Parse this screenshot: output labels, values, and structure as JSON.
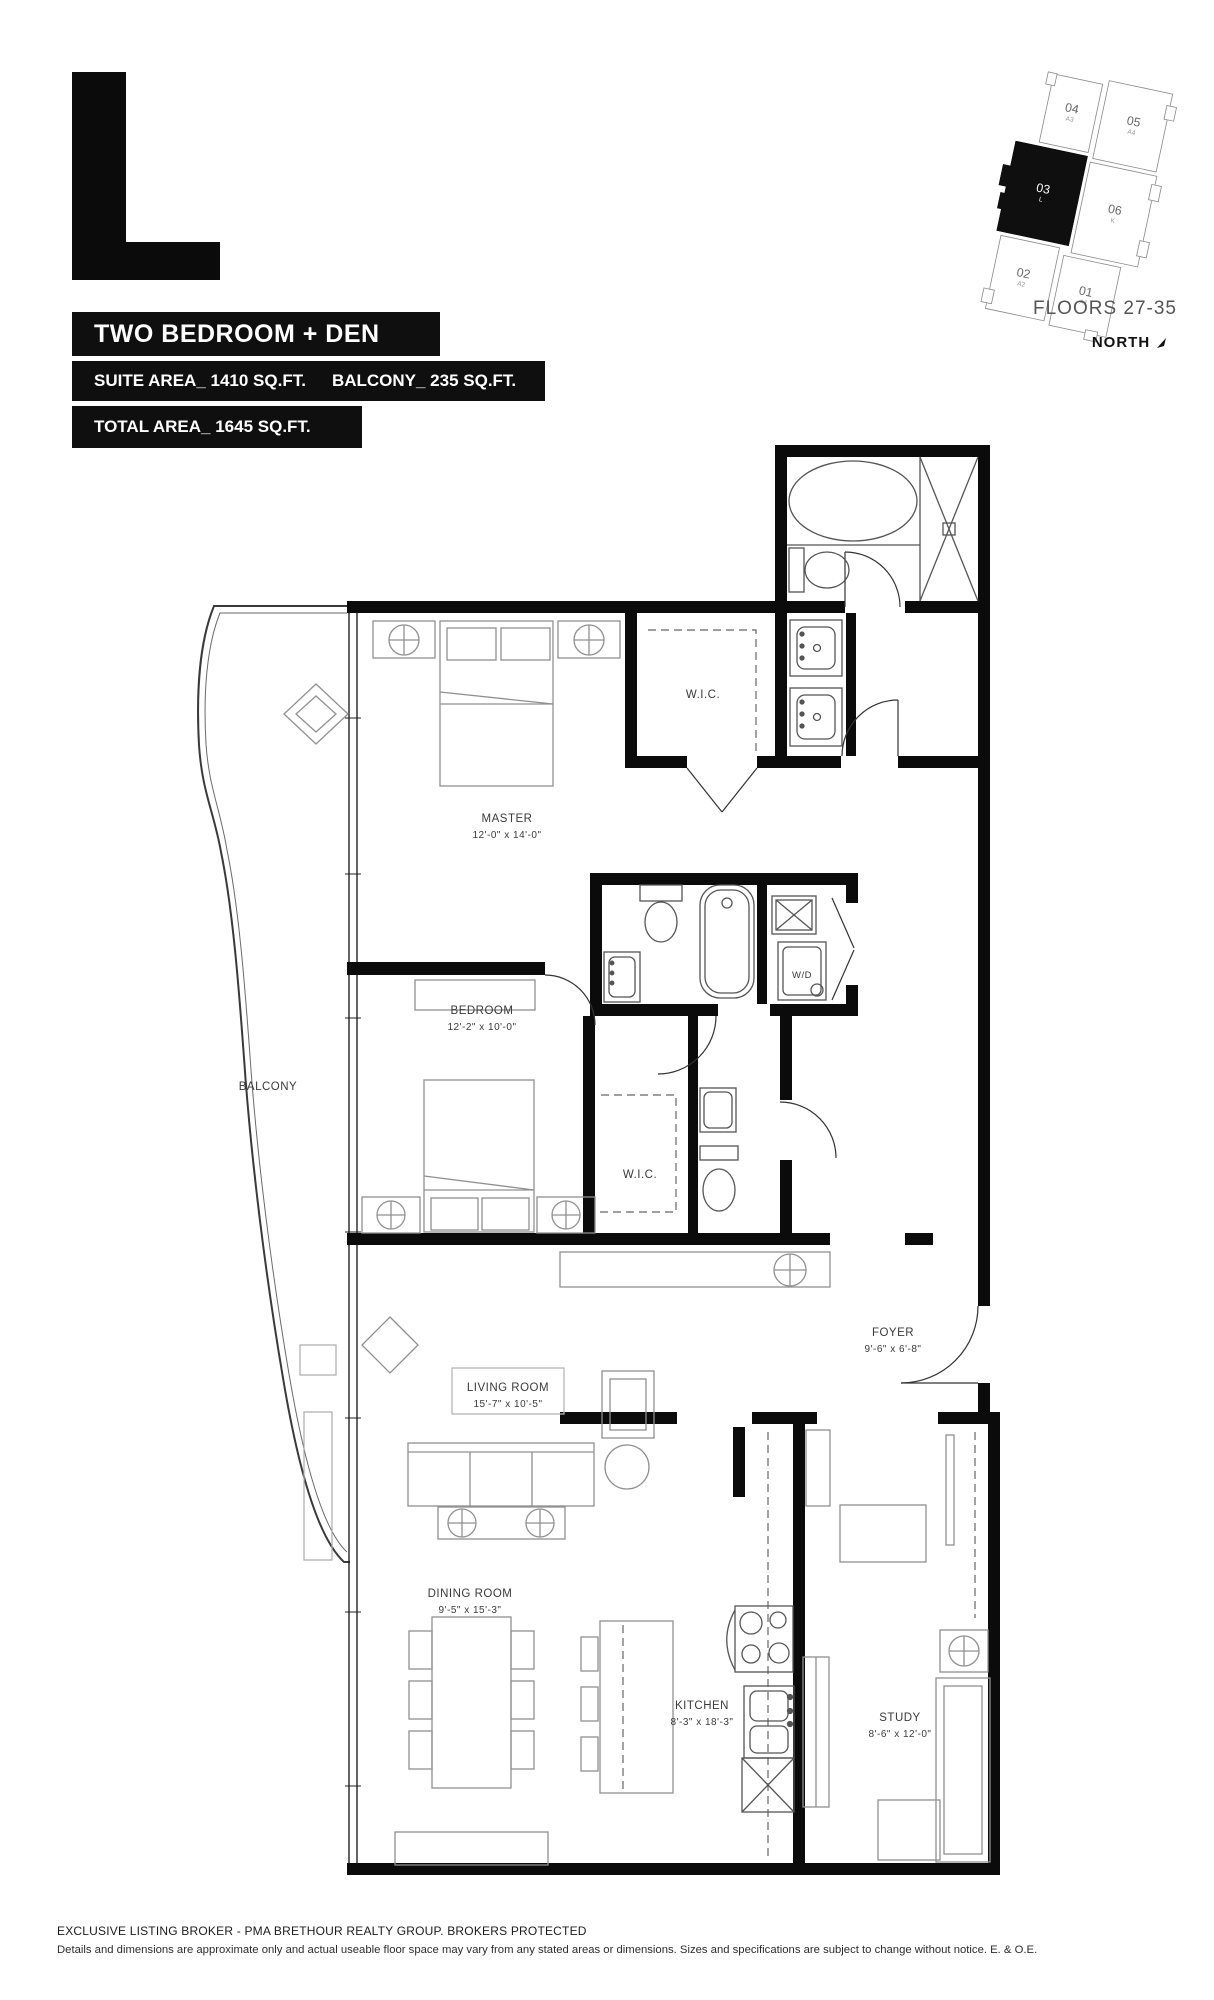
{
  "suite": {
    "letter": "L",
    "type": "TWO BEDROOM + DEN",
    "suite_area": "SUITE AREA_ 1410 SQ.FT.",
    "balcony_area": "BALCONY_ 235 SQ.FT.",
    "total_area": "TOTAL AREA_ 1645 SQ.FT."
  },
  "keyplan": {
    "floors": "FLOORS 27-35",
    "north": "NORTH",
    "units": [
      {
        "num": "04",
        "code": "A3"
      },
      {
        "num": "05",
        "code": "A4"
      },
      {
        "num": "03",
        "code": "L",
        "highlighted": true
      },
      {
        "num": "06",
        "code": "K"
      },
      {
        "num": "02",
        "code": "A2"
      },
      {
        "num": "01",
        "code": "A1"
      }
    ]
  },
  "rooms": [
    {
      "name": "MASTER",
      "dims": "12'-0\" x 14'-0\""
    },
    {
      "name": "W.I.C.",
      "dims": ""
    },
    {
      "name": "BEDROOM",
      "dims": "12'-2\" x 10'-0\""
    },
    {
      "name": "W.I.C.",
      "dims": ""
    },
    {
      "name": "BALCONY",
      "dims": ""
    },
    {
      "name": "FOYER",
      "dims": "9'-6\" x 6'-8\""
    },
    {
      "name": "LIVING ROOM",
      "dims": "15'-7\" x 10'-5\""
    },
    {
      "name": "DINING ROOM",
      "dims": "9'-5\" x 15'-3\""
    },
    {
      "name": "KITCHEN",
      "dims": "8'-3\" x 18'-3\""
    },
    {
      "name": "STUDY",
      "dims": "8'-6\" x 12'-0\""
    },
    {
      "name": "W/D",
      "dims": ""
    }
  ],
  "footer": {
    "broker": "EXCLUSIVE LISTING BROKER - PMA BRETHOUR REALTY GROUP. BROKERS PROTECTED",
    "disclaimer": "Details and dimensions are approximate only and actual useable floor space may vary from any stated areas or dimensions. Sizes and specifications are subject to change without notice. E. & O.E."
  },
  "colors": {
    "banner_bg": "#0f0f0f",
    "banner_text": "#ffffff",
    "wall": "#0b0b0b",
    "furniture_line": "#909090",
    "fixture_line": "#555555"
  }
}
